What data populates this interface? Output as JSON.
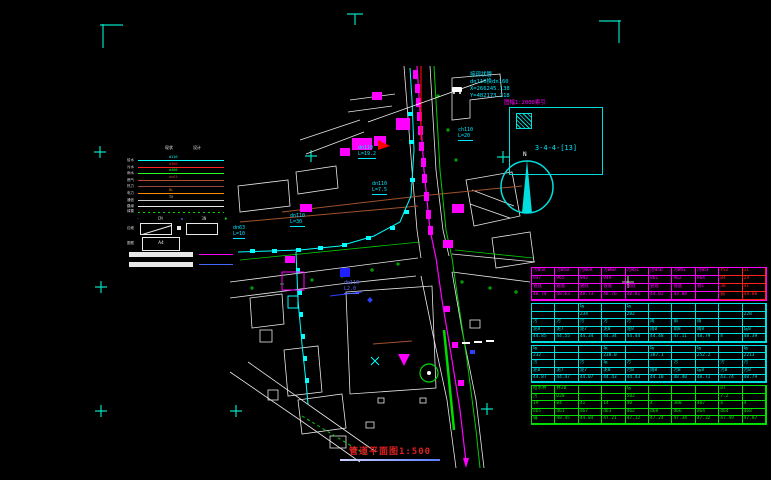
{
  "colors": {
    "cyan": "#00ffff",
    "magenta": "#ff00ff",
    "green": "#00cc00",
    "red": "#ff0000",
    "white": "#e8e8e8",
    "brown": "#a0522d",
    "orange": "#ff8800",
    "blue": "#4455ff",
    "table_green": "#00e000",
    "title_red": "#e02020"
  },
  "sheet": {
    "title": "管道平面图1:500"
  },
  "north": {
    "label": "N"
  },
  "index_box": {
    "caption": "图幅1:2000索引",
    "sheet_no": "3-4-4-[13]"
  },
  "annotation": {
    "line1": "接现状管",
    "line2": "dn110换dn160",
    "line3": "X=266245.138",
    "line4": "Y=482173.218"
  },
  "map_labels": [
    {
      "text": "dn63",
      "text2": "L=10"
    },
    {
      "text": "dn110",
      "text2": "L=30"
    },
    {
      "text": "dn110",
      "text2": "L=19.2"
    },
    {
      "text": "dn110",
      "text2": "L=7.5"
    },
    {
      "text": "ch110",
      "text2": "L=20"
    },
    {
      "text": "dn110",
      "text2": "L2.0"
    }
  ],
  "legend": {
    "headers": [
      "现状",
      "设计"
    ],
    "rows": [
      {
        "label": "给水",
        "color": "#00ffff",
        "tag": "d110"
      },
      {
        "label": "污水",
        "color": "#ff2222",
        "tag": "d300"
      },
      {
        "label": "雨水",
        "color": "#22ff22",
        "tag": "d400"
      },
      {
        "label": "燃气",
        "color": "#b05030",
        "tag": "dn63"
      },
      {
        "label": "热力",
        "color": "#96483c",
        "tag": ""
      },
      {
        "label": "电力",
        "color": "#ff8800",
        "tag": "DL"
      },
      {
        "label": "通信",
        "color": "#cccccc",
        "tag": "TX"
      },
      {
        "label": "路缘",
        "color": "#e8e8e8",
        "tag": ""
      }
    ],
    "hedge_label": "绿篱",
    "symbols": [
      {
        "text": "—",
        "color": "#4455ff"
      },
      {
        "text": "CM",
        "color": "#cccccc"
      },
      {
        "text": "◆",
        "color": "#4455ff"
      },
      {
        "text": "3N",
        "color": "#cccccc"
      },
      {
        "text": "♣",
        "color": "#22ff22"
      }
    ],
    "box_row_label": "边坡",
    "frame_label": "图框",
    "frame_text": "A4"
  },
  "table": {
    "groups": [
      {
        "color": "#ff00ff",
        "red_color": "#ff2020",
        "red_cols": [
          8,
          9
        ],
        "height": 32,
        "rows": [
          [
            "污W5A",
            "污W5B",
            "污W6A",
            "污W6B",
            "污W5C",
            "污W5D",
            "污W5E",
            "污W5F",
            "YS2",
            "J1"
          ],
          [
            "947",
            "965",
            "942",
            "949",
            "",
            "961",
            "962",
            "964",
            "84",
            "24"
          ],
          [
            "管底",
            "管底",
            "管底",
            "管底",
            "管底",
            "管底",
            "管底",
            "管L",
            "38",
            "41"
          ],
          [
            "48.74",
            "48.63",
            "48.73",
            "48.76",
            "48.81",
            "44.82",
            "43.84",
            "",
            "铺",
            "44.80"
          ]
        ]
      },
      {
        "color": "#00e0e0",
        "red_cols": [],
        "height": 38,
        "rows": [
          [
            "",
            "",
            "坛",
            "",
            "坛",
            "",
            "",
            "",
            "",
            ""
          ],
          [
            "",
            "",
            "234",
            "",
            "282",
            "",
            "",
            "",
            "",
            "228"
          ],
          [
            "污",
            "污",
            "污",
            "污",
            "污",
            "雨",
            "雨",
            "雨",
            "",
            ""
          ],
          [
            "泥8",
            "泥7",
            "泥7",
            "泥8",
            "泥8",
            "雨8",
            "雨8",
            "雨8",
            "",
            "坛8"
          ],
          [
            "44.85",
            "44.55",
            "44.34",
            "44.34",
            "44.44",
            "44.48",
            "47.11",
            "48.79",
            "≡",
            "48.39"
          ]
        ]
      },
      {
        "color": "#00e0e0",
        "red_cols": [],
        "height": 36,
        "rows": [
          [
            "坛",
            "",
            "",
            "坛",
            "",
            "坛",
            "",
            "坛",
            "",
            "坛"
          ],
          [
            "232",
            "",
            "",
            "238.0",
            "",
            "387.1",
            "",
            "252.2",
            "",
            "2213"
          ],
          [
            "污",
            "",
            "污",
            "坛",
            "污",
            "",
            "污",
            "",
            "污",
            "污"
          ],
          [
            "泥8",
            "泥7",
            "泥7",
            "泥8",
            "污8",
            "雨8",
            "污8",
            "坛8",
            "污8",
            "污8"
          ],
          [
            "44.87",
            "44.47",
            "44.07",
            "44.43",
            "44.43",
            "44.10",
            "48.40",
            "48.71",
            "43.74",
            "48.79"
          ]
        ]
      },
      {
        "color": "#00e000",
        "red_cols": [],
        "height": 38,
        "rows": [
          [
            "给水井",
            "井20",
            "",
            "",
            "坛",
            "",
            "",
            "",
            "87",
            ""
          ],
          [
            "污",
            "D20",
            "",
            "",
            "502",
            "",
            "",
            "",
            "7.2",
            ""
          ],
          [
            "19",
            "84",
            "41",
            "14",
            "40",
            "4",
            "380",
            "487",
            "4",
            "4"
          ],
          [
            "d65",
            "d61",
            "d67",
            "d63",
            "d62",
            "d68",
            "d66",
            "d64",
            "d64",
            "d68"
          ],
          [
            "铺",
            "48.45",
            "44.84",
            "47.21",
            "47.12",
            "47.24",
            "47.34",
            "47.32",
            "47.49",
            "47.87"
          ]
        ]
      }
    ]
  }
}
